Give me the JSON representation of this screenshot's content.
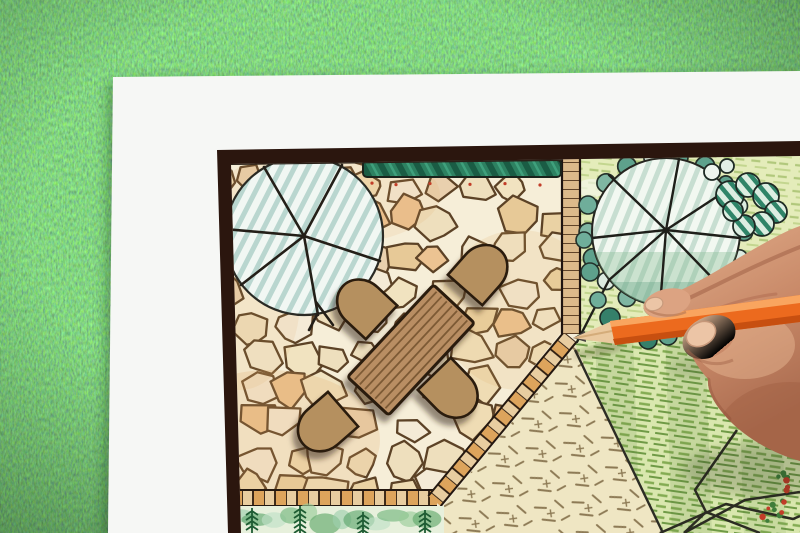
{
  "scene": {
    "type": "photograph",
    "description": "Top-down photo of a hand drawing a backyard garden landscape plan with an orange colored pencil; the plan sheet lies on green grass",
    "grass": {
      "label": "grass-lawn-background",
      "base_color": "#4a7a3e"
    },
    "paper": {
      "label": "white-paper-sheet",
      "color": "#f6f7f5"
    },
    "plan": {
      "label": "garden-plan-drawing",
      "frame_color": "#2b160e",
      "patio": {
        "label": "flagstone-patio",
        "base_color": "#f6eed8",
        "joint_color": "#5c4226",
        "stone_colors": [
          "#f2e7cd",
          "#eedfbd",
          "#ead2a4",
          "#f4ead6",
          "#e7c997",
          "#efdcb4",
          "#e9d0ae",
          "#f1e3c0",
          "#ecc392"
        ]
      },
      "table": {
        "label": "wooden-dining-table",
        "top_color": "#b98e63",
        "plank_color": "#7d5a35",
        "outline_color": "#2a1a0e"
      },
      "chairs": {
        "label": "patio-chair",
        "count": 4,
        "color": "#b5905f",
        "outline_color": "#2a1a0e"
      },
      "tree_left": {
        "label": "tree-canopy-symbol",
        "hatch_color": "#b9d6cf"
      },
      "tree_right": {
        "label": "tree-canopy-symbol-with-shrub-ring",
        "hatch_color": "#c7ded1",
        "ring_teal": "#5ea18c",
        "ring_pale": "#dcebe0"
      },
      "hedge": {
        "label": "hedge-strip",
        "color": "#2d8161"
      },
      "paving": {
        "label": "brick-paver-edging",
        "brick_light": "#e8cda0",
        "brick_orange": "#dda45c",
        "ladder_color": "#dcba8b"
      },
      "lawn": {
        "label": "lawn-hatched-area",
        "stroke_color": "#84ac53"
      },
      "groundcover": {
        "label": "dashed-groundcover-area",
        "color": "#efe6c3",
        "dash_color": "#8d7a55"
      },
      "planting_bed": {
        "label": "planting-bed-watercolor",
        "colors": [
          "#9ed0ad",
          "#5fa86e",
          "#bfe0c6",
          "#74b77e",
          "#99cc9a",
          "#62a96c"
        ],
        "sprig_color": "#1e5c33"
      },
      "accents": {
        "red_dot_color": "#c23d28",
        "green_dot_color": "#3f7d3a"
      }
    },
    "pencil": {
      "label": "orange-colored-pencil",
      "body_color": "#ec6a1e",
      "highlight_color": "#f9a55f",
      "shade_color": "#c74f10",
      "wood_color": "#eac99f",
      "lead_color": "#474340"
    },
    "hand": {
      "label": "hand-holding-pencil",
      "skin_light": "#e3b08d",
      "skin_mid": "#c98a69",
      "skin_shadow": "#a05f43",
      "nail_color": "#ecc5a6"
    }
  }
}
